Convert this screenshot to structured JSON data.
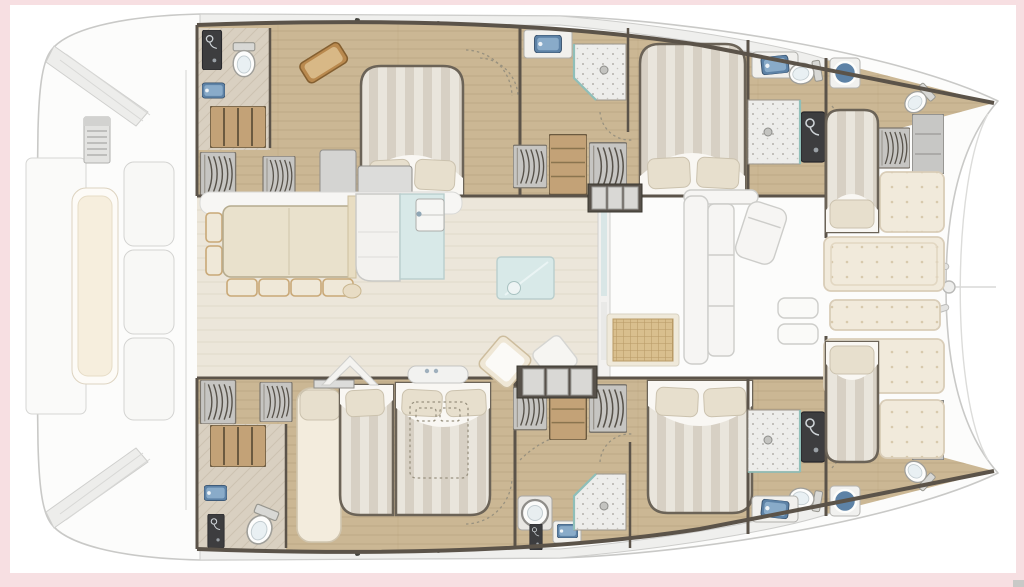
{
  "figure": {
    "type": "floor-plan",
    "subject": "catamaran-yacht-interior-layout-top-view",
    "orientation": "bow-right-stern-left",
    "decks": [
      "main-deck-salon",
      "starboard-hull",
      "port-hull",
      "foredeck",
      "aft-deck"
    ]
  },
  "areas": {
    "salon": [
      "dining-table",
      "galley-counters",
      "island-glass-table",
      "companionway-steps"
    ],
    "starboard_hull": [
      "aft-bathroom",
      "aft-double-cabin",
      "mid-bathroom-shower",
      "mid-double-cabin",
      "forward-bathroom",
      "bow-berth"
    ],
    "port_hull": [
      "aft-bathroom",
      "aft-twin-double-cabin",
      "mid-bathroom-shower",
      "mid-double-cabin",
      "forward-bathroom",
      "bow-berth"
    ],
    "foredeck": [
      "forward-cockpit-sofa",
      "sun-pads"
    ],
    "aft_deck": [
      "cockpit-bench",
      "grill-console",
      "transom-steps"
    ]
  },
  "counts": {
    "double_beds": 5,
    "single_berths": 2,
    "bathrooms": 6,
    "toilets": 6,
    "showers": 4,
    "wash_basins": 10,
    "dining_chairs": 6,
    "sun_pads": 5,
    "hanging_lockers": 8
  },
  "colors": {
    "frame_pink": "#f7dfe2",
    "canvas": "#ffffff",
    "ghost_line": "#c9c9c7",
    "ghost_fill": "#fcfcfb",
    "deck_band": "#efefed",
    "hull_wall": "#5b5349",
    "wood": "#cbb794",
    "wood_line": "#b29c77",
    "head_floor": "#d9d0c1",
    "salon_floor": "#ece6da",
    "salon_line": "#e2dbcb",
    "bed_light": "#e9e5dc",
    "bed_dark": "#d7d0c4",
    "sheet": "#f9f7f3",
    "pillow": "#e7dfcd",
    "pad": "#f1eadb",
    "pad_dot": "#d8c9ac",
    "dark_panel": "#3d3d3f",
    "sink_blue": "#89abc9",
    "sink_blue_deep": "#5d82a6",
    "toilet": "#fdfdfc",
    "speckle": "#ededeb",
    "locker_gray": "#c6c5c2",
    "locker_arc": "#57524a",
    "shelf_wood": "#c3a277",
    "table_cream": "#e9e1cc",
    "chair_tan": "#c9a877",
    "chair_top": "#efe8d8",
    "glass": "#d8e9e8",
    "teal": "#8fbfb9",
    "wicker": "#d9bf8e",
    "wicker_line": "#b89a66",
    "bench_cream": "#f6eedd",
    "steps_dark": "#57514a",
    "tread": "#d9d8d5",
    "watermark": "#c9c9c7"
  }
}
